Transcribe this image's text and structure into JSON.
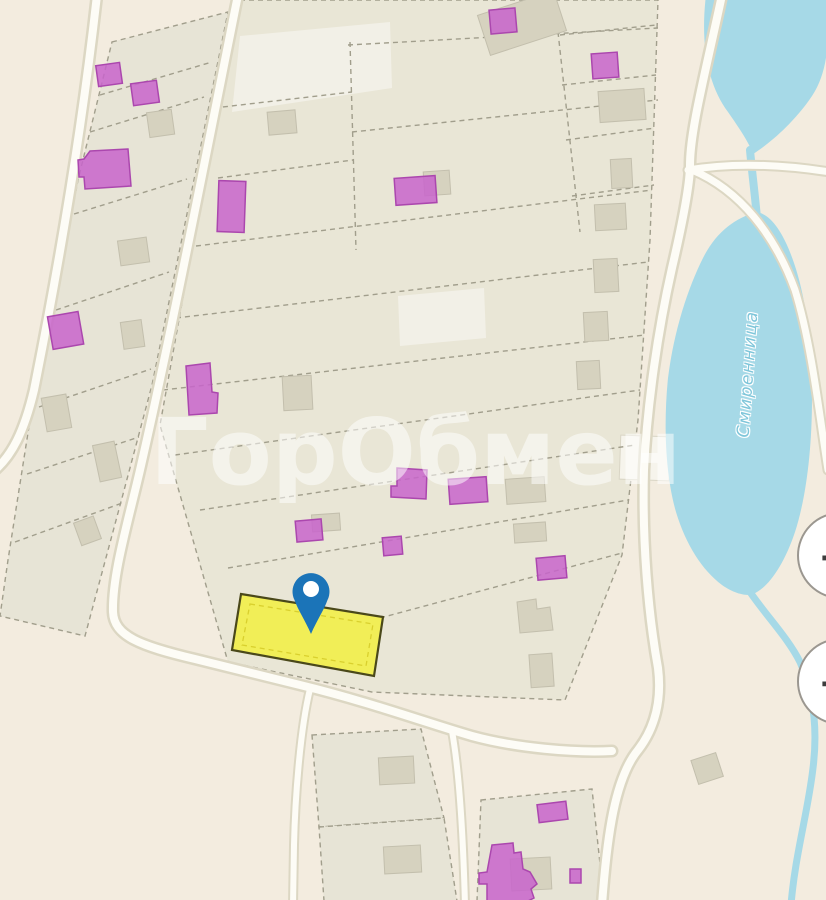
{
  "watermark": {
    "text": "ГорОбмен"
  },
  "water": {
    "river_label": "Смиренница"
  },
  "controls": {
    "zoom_in_label": "+",
    "zoom_out_label": "−"
  },
  "marker": {
    "icon": "location-pin-icon",
    "color": "#1b74b8"
  },
  "highlight": {
    "fill": "#f2ee49",
    "border": "#4a481a"
  },
  "palette": {
    "background": "#f3ecdf",
    "parcel_fill": "#e9e6d6",
    "parcel_border": "#a19e8c",
    "road_fill": "#fdfcf6",
    "road_casing": "#dcd7c3",
    "water": "#a6d9e7",
    "building_gray": "#d6d2bf",
    "building_purple": "#c864cb",
    "building_purple_border": "#ab47ae"
  }
}
